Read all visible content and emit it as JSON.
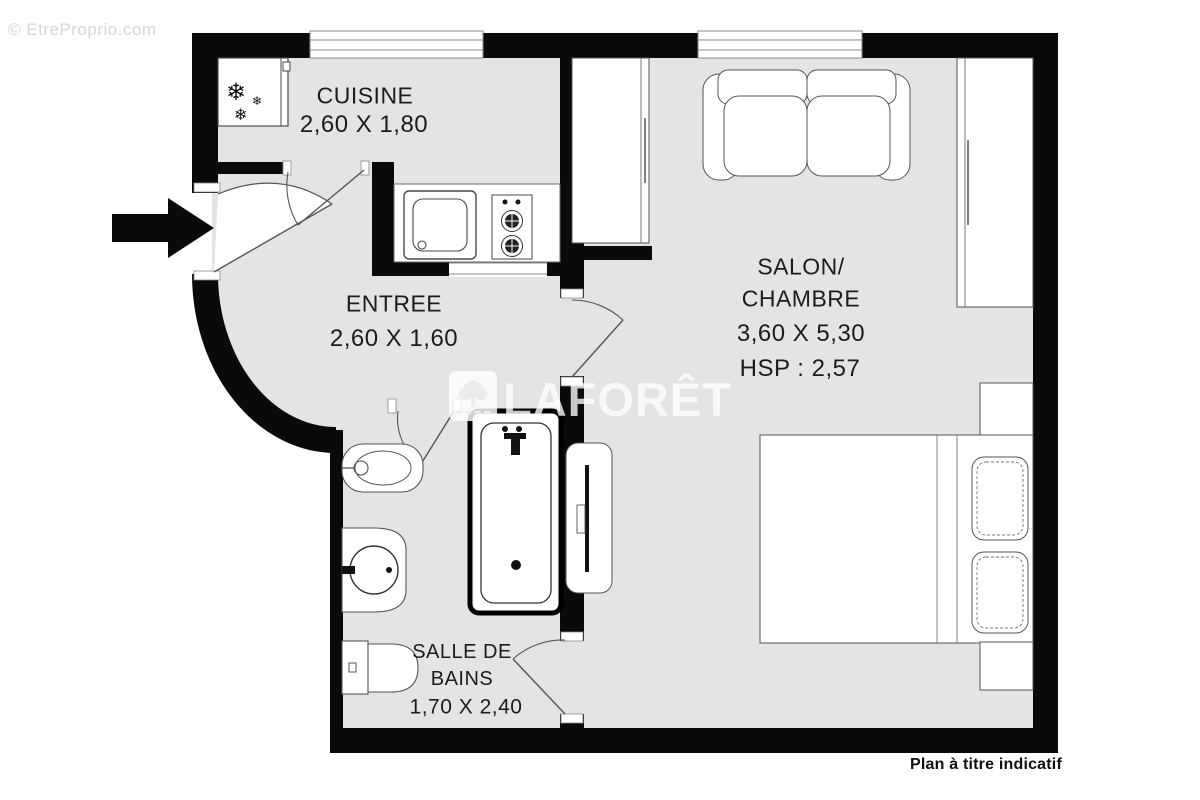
{
  "watermarks": {
    "top_left": "© EtreProprio.com",
    "brand": "LAFORÊT",
    "disclaimer": "Plan à titre indicatif"
  },
  "rooms": {
    "cuisine": {
      "name": "CUISINE",
      "dims": "2,60 X 1,80"
    },
    "entree": {
      "name": "ENTREE",
      "dims": "2,60 X 1,60"
    },
    "salon": {
      "name_line1": "SALON/",
      "name_line2": "CHAMBRE",
      "dims": "3,60 X 5,30",
      "hsp": "HSP : 2,57"
    },
    "salle_de_bains": {
      "name_line1": "SALLE DE",
      "name_line2": "BAINS",
      "dims": "1,70 X 2,40"
    }
  },
  "icons": {
    "snowflake_large": "❄",
    "snowflake_small": "❄",
    "snowflake_medium": "❄"
  },
  "colors": {
    "wall": "#0a0a0a",
    "floor": "#e4e4e4",
    "fixture_stroke": "#4a4a4a",
    "watermark_white": "#ffffff",
    "watermark_gray": "#d7d7d7"
  }
}
